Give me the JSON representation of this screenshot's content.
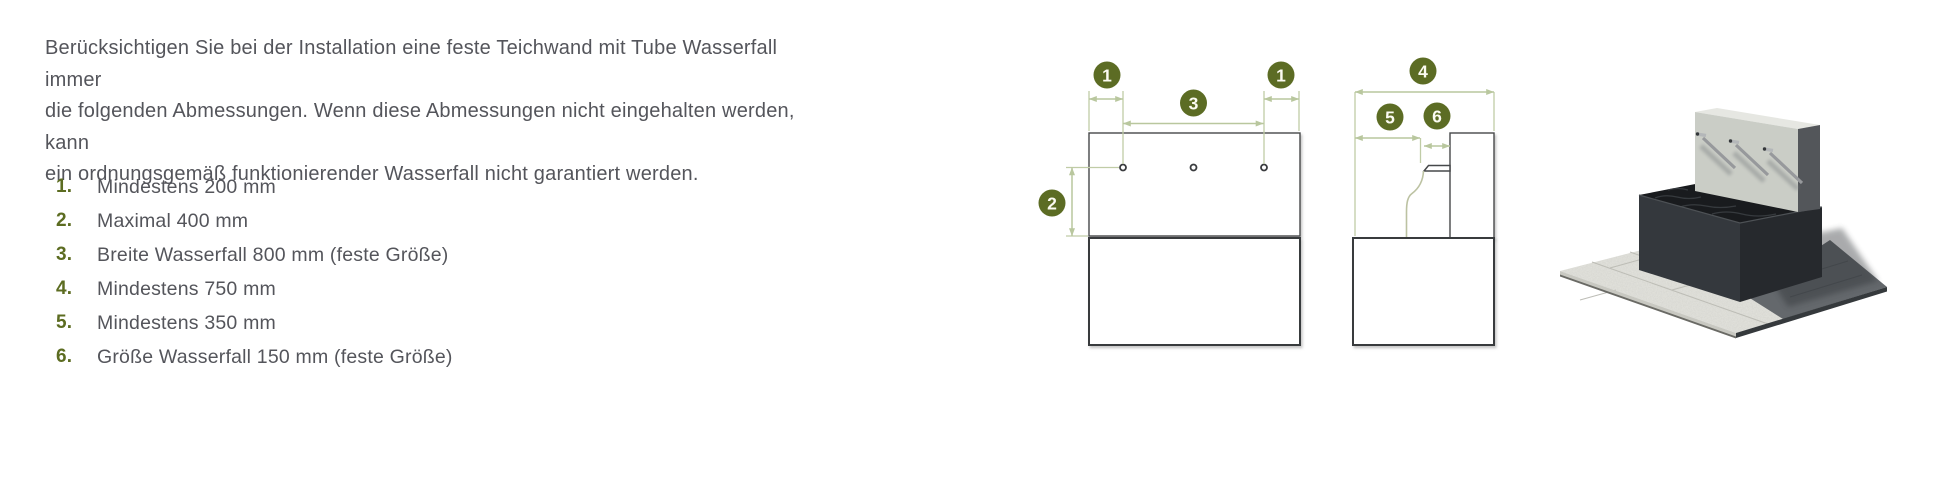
{
  "intro": {
    "lines": [
      "Berücksichtigen Sie bei der Installation eine feste Teichwand mit Tube Wasserfall immer",
      "die folgenden Abmessungen. Wenn diese Abmessungen nicht eingehalten werden, kann",
      "ein ordnungsgemäß funktionierender Wasserfall nicht garantiert werden."
    ]
  },
  "list": {
    "items": [
      {
        "number": "1.",
        "text": "Mindestens 200 mm"
      },
      {
        "number": "2.",
        "text": "Maximal 400 mm"
      },
      {
        "number": "3.",
        "text": "Breite Wasserfall 800 mm (feste Größe)"
      },
      {
        "number": "4.",
        "text": "Mindestens 750 mm"
      },
      {
        "number": "5.",
        "text": "Mindestens 350 mm"
      },
      {
        "number": "6.",
        "text": "Größe Wasserfall 150 mm (feste Größe)"
      }
    ]
  },
  "diagrams": {
    "front_view": {
      "marker_offset_left": "1",
      "marker_width": "3",
      "marker_offset_right": "1",
      "marker_depth": "2"
    },
    "side_view": {
      "marker_total_height": "4",
      "marker_min_distance": "5",
      "marker_waterfall_size": "6"
    }
  },
  "colors": {
    "accent_olive": "#5c6c24",
    "dimension_line": "#b9c79e",
    "body_text": "#54555b",
    "outline": "#46484a"
  }
}
